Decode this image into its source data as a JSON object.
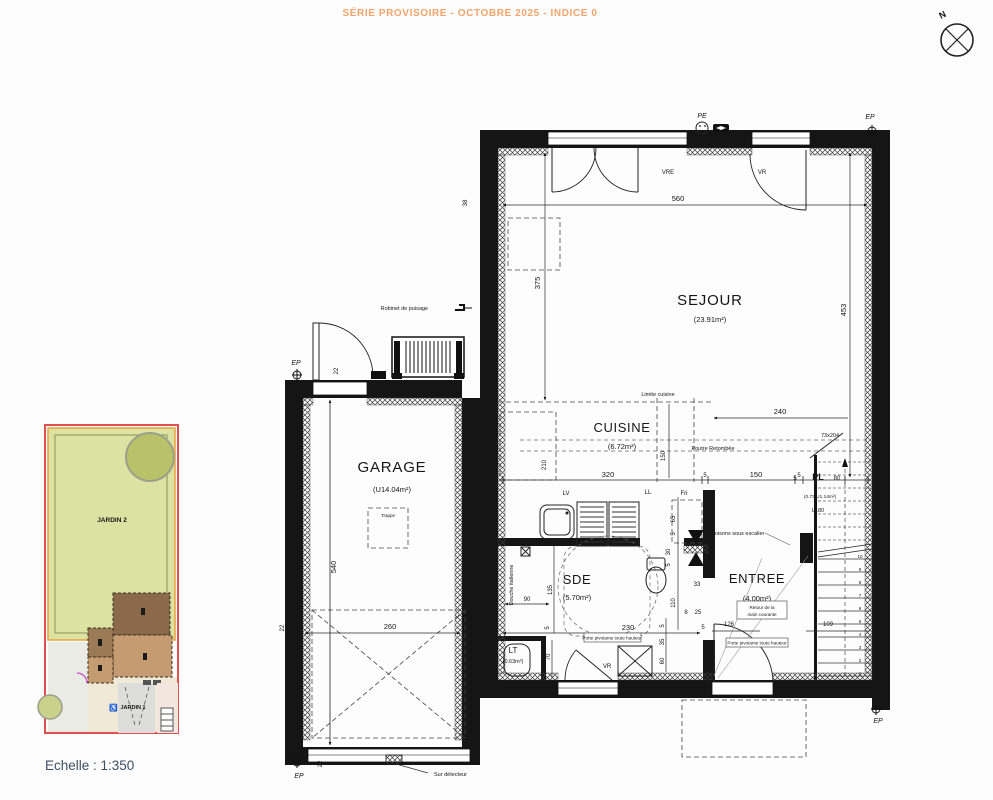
{
  "header": {
    "title": "SÉRIE PROVISOIRE - OCTOBRE 2025 - INDICE 0"
  },
  "compass": {
    "north": "N"
  },
  "scale_label": "Echelle : 1:350",
  "site_plan": {
    "jardin2": "JARDIN 2",
    "jardin1": "JARDIN 1",
    "wheelchair_icon": "♿"
  },
  "rooms": {
    "sejour": {
      "name": "SEJOUR",
      "area": "(23.91m²)"
    },
    "cuisine": {
      "name": "CUISINE",
      "area": "(6.72m²)"
    },
    "garage": {
      "name": "GARAGE",
      "area": "(U14.04m²)"
    },
    "sde": {
      "name": "SDE",
      "area": "(5.70m²)"
    },
    "entree": {
      "name": "ENTREE",
      "area": "(4.00m²)"
    },
    "lt": {
      "name": "LT",
      "area": "(0.63m²)"
    },
    "pl": {
      "name": "PL",
      "detail": "(0.73 U1.14m²)",
      "width_label": "L180",
      "door_size": "73x204"
    }
  },
  "labels": {
    "vre": "VRE",
    "vr": "VR",
    "pe": "PE",
    "ep": "EP",
    "lv": "LV",
    "ll": "LL",
    "fri": "Fri",
    "limite_cuisine": "Limite cuisine",
    "poutre": "Poutre Retombée",
    "robinet": "Robinet de puisage",
    "cloisons": "Cloisons sous escalier",
    "retour_l1": "Retour de la",
    "retour_l2": "main courante",
    "porte_pivotante": "Porte pivotante toute hauteur",
    "sur_detecteur": "Sur détecteur",
    "douche": "Douche italienne",
    "trappe": "Trappe"
  },
  "dims": {
    "d560": "560",
    "d375": "375",
    "d453": "453",
    "d38": "38",
    "d22": "22",
    "d540": "540",
    "d260": "260",
    "d240": "240",
    "d320": "320",
    "d150": "150",
    "d5": "5",
    "d80": "80",
    "d210": "210",
    "d65": "65",
    "d30": "30",
    "d33": "33",
    "d110": "110",
    "d8": "8",
    "d25": "25",
    "d230": "230",
    "d135": "135",
    "d90": "90",
    "d70": "70",
    "d126": "126",
    "d109": "109",
    "d35": "35",
    "d60": "60"
  },
  "stairs": {
    "steps": [
      "1",
      "2",
      "3",
      "4",
      "5",
      "6",
      "7",
      "8",
      "9",
      "10"
    ]
  },
  "colors": {
    "title_orange": "#F2A46B",
    "plan_ink": "#151515",
    "scale_text": "#3D4F63",
    "garden_green": "#DCE3A2",
    "tree_green": "#B9C169",
    "parcel_red": "#E05050",
    "building_dark_brown": "#8A6A4B",
    "building_light_brown": "#C59B71",
    "north_blue": "#1F4E9C"
  }
}
